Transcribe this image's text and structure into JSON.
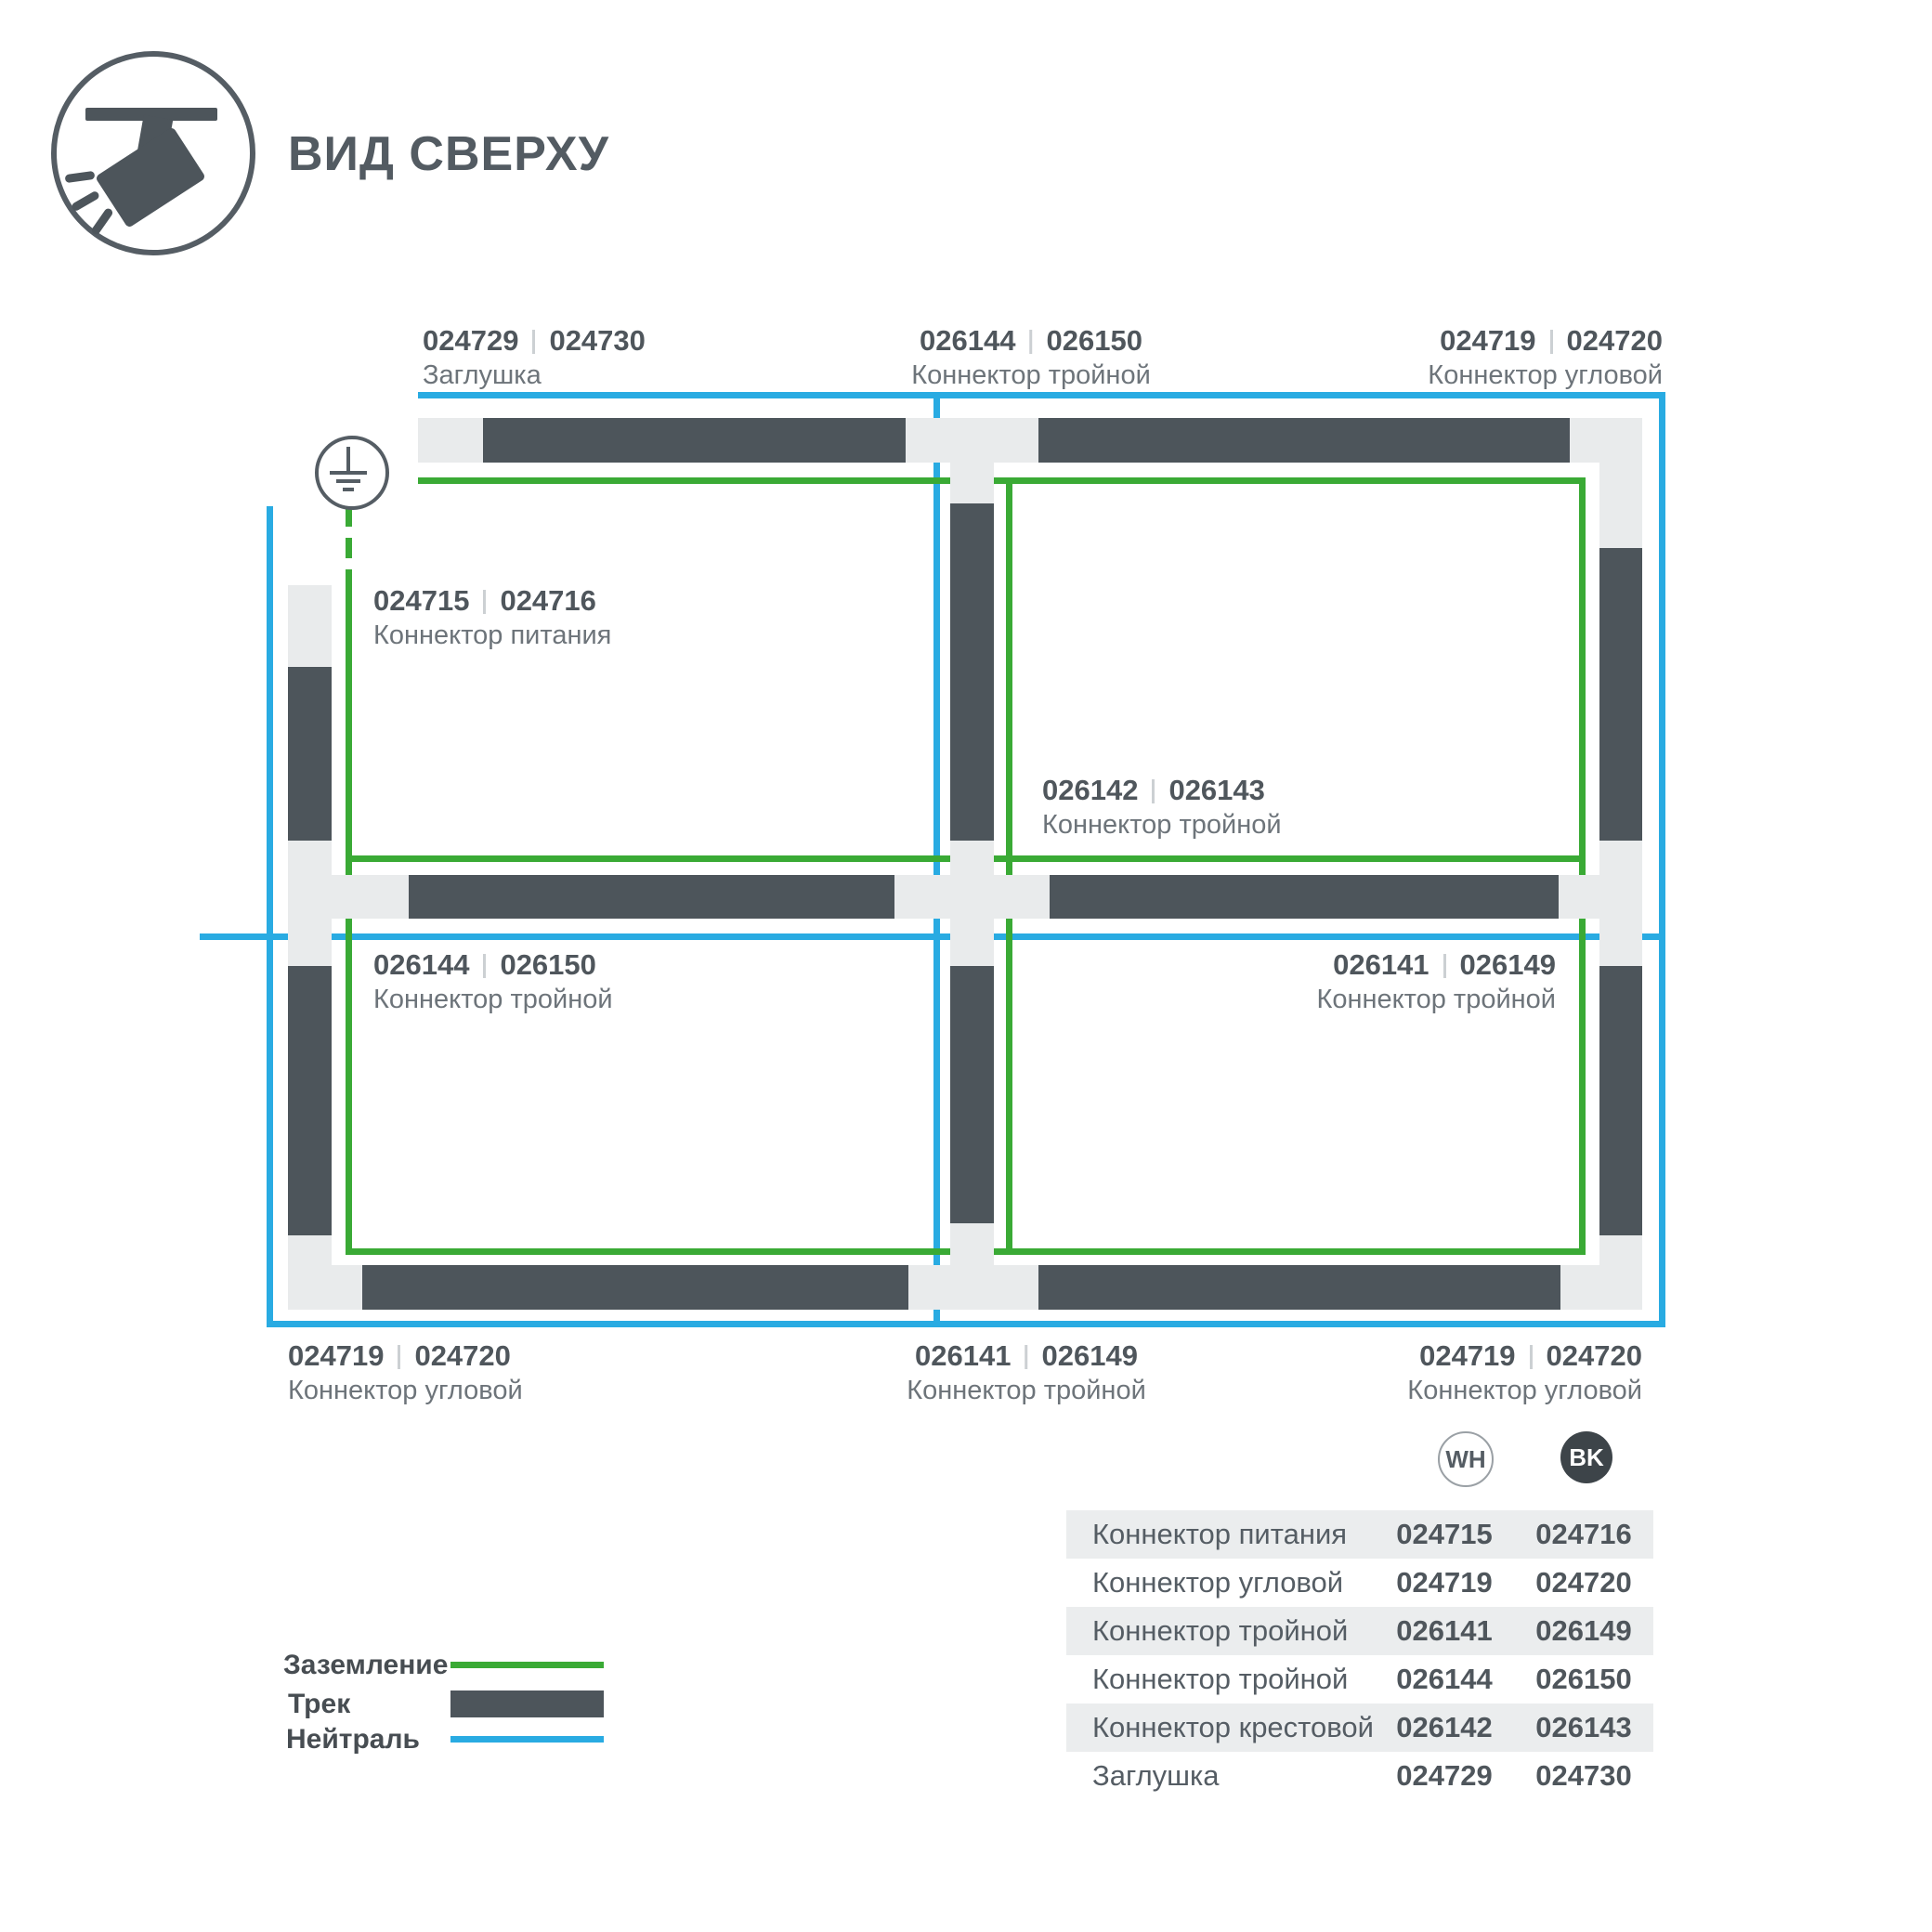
{
  "title": {
    "text": "ВИД СВЕРХУ"
  },
  "colors": {
    "track": "#4d555b",
    "connector": "#e9ebec",
    "ground_line": "#3aaa35",
    "neutral_line": "#29abe2",
    "text": "#555d64",
    "table_shade": "#ebedee",
    "bk_badge": "#3d4449"
  },
  "part_labels": {
    "top_left": {
      "wh": "024729",
      "bk": "024730",
      "name": "Заглушка"
    },
    "top_center": {
      "wh": "026144",
      "bk": "026150",
      "name": "Коннектор тройной"
    },
    "top_right": {
      "wh": "024719",
      "bk": "024720",
      "name": "Коннектор угловой"
    },
    "power": {
      "wh": "024715",
      "bk": "024716",
      "name": "Коннектор питания"
    },
    "cross": {
      "wh": "026142",
      "bk": "026143",
      "name": "Коннектор тройной"
    },
    "mid_left": {
      "wh": "026144",
      "bk": "026150",
      "name": "Коннектор тройной"
    },
    "mid_right": {
      "wh": "026141",
      "bk": "026149",
      "name": "Коннектор тройной"
    },
    "bottom_left": {
      "wh": "024719",
      "bk": "024720",
      "name": "Коннектор угловой"
    },
    "bottom_center": {
      "wh": "026141",
      "bk": "026149",
      "name": "Коннектор тройной"
    },
    "bottom_right": {
      "wh": "024719",
      "bk": "024720",
      "name": "Коннектор угловой"
    }
  },
  "legend": {
    "items": [
      {
        "label": "Заземление",
        "type": "ground-line",
        "color": "#3aaa35"
      },
      {
        "label": "Трек",
        "type": "track-bar",
        "color": "#4d555b"
      },
      {
        "label": "Нейтраль",
        "type": "neutral-line",
        "color": "#29abe2"
      }
    ]
  },
  "table": {
    "header": {
      "wh": "WH",
      "bk": "BK"
    },
    "rows": [
      {
        "name": "Коннектор питания",
        "wh": "024715",
        "bk": "024716"
      },
      {
        "name": "Коннектор угловой",
        "wh": "024719",
        "bk": "024720"
      },
      {
        "name": "Коннектор тройной",
        "wh": "026141",
        "bk": "026149"
      },
      {
        "name": "Коннектор тройной",
        "wh": "026144",
        "bk": "026150"
      },
      {
        "name": "Коннектор крестовой",
        "wh": "026142",
        "bk": "026143"
      },
      {
        "name": "Заглушка",
        "wh": "024729",
        "bk": "024730"
      }
    ]
  }
}
